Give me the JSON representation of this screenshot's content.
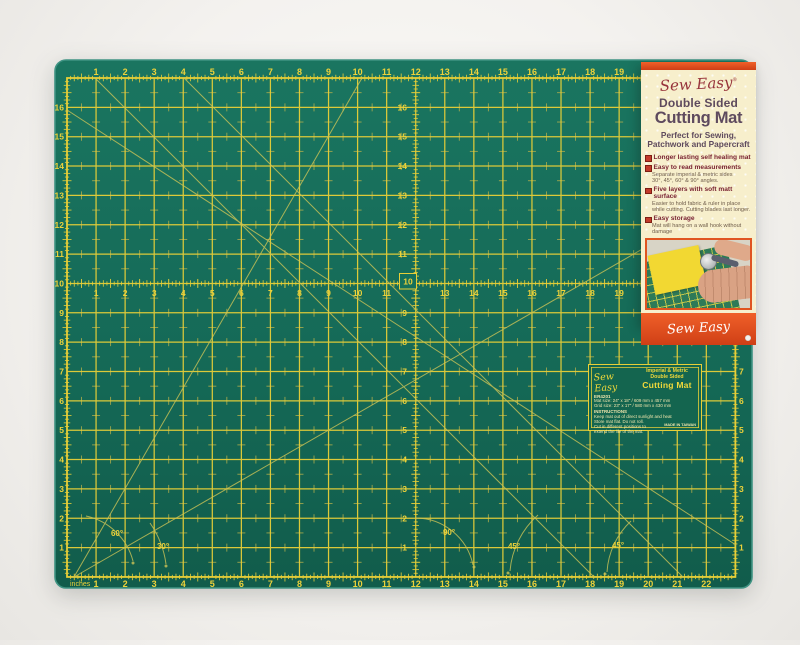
{
  "colors": {
    "background": "#f4f2ef",
    "mat_green": "#156a57",
    "mat_green_dark": "#115c4b",
    "mat_edge": "#3f9383",
    "grid_yellow": "#e7cf38",
    "grid_faint": "#b5b04c",
    "number_yellow": "#edd23a",
    "diagonal_yellow": "#cdc456",
    "label_cream": "#f7efcc",
    "label_orange": "#e3501e",
    "brand_red": "#97333b",
    "title_plum": "#5e4a5e",
    "bullet_red": "#c23b2a",
    "mat_label_text": "#f2e7ad"
  },
  "mat": {
    "unit_label": "inches",
    "rulers": {
      "top": [
        "1",
        "2",
        "3",
        "4",
        "5",
        "6",
        "7",
        "8",
        "9",
        "10",
        "11",
        "12",
        "13",
        "14",
        "15",
        "16",
        "17",
        "18",
        "19"
      ],
      "bottom": [
        "1",
        "2",
        "3",
        "4",
        "5",
        "6",
        "7",
        "8",
        "9",
        "10",
        "11",
        "12",
        "13",
        "14",
        "15",
        "16",
        "17",
        "18",
        "19",
        "20",
        "21",
        "22"
      ],
      "left": [
        "16",
        "15",
        "14",
        "13",
        "12",
        "11",
        "10",
        "9",
        "8",
        "7",
        "6",
        "5",
        "4",
        "3",
        "2",
        "1"
      ],
      "right": [
        "8",
        "7",
        "6",
        "5",
        "4",
        "3",
        "2",
        "1"
      ],
      "mid_horizontal": [
        "1",
        "2",
        "3",
        "4",
        "5",
        "6",
        "7",
        "8",
        "9",
        "10",
        "11",
        "13",
        "14",
        "15",
        "16",
        "17",
        "18",
        "19"
      ],
      "mid_vertical": [
        "16",
        "15",
        "14",
        "13",
        "12",
        "11",
        "9",
        "8",
        "7",
        "6",
        "5",
        "4",
        "3",
        "2",
        "1"
      ]
    },
    "center_marker": "10",
    "angle_labels": [
      {
        "text": "60°",
        "x": 117,
        "y": 536
      },
      {
        "text": "30°",
        "x": 163,
        "y": 549
      },
      {
        "text": "90°",
        "x": 449,
        "y": 535
      },
      {
        "text": "45°",
        "x": 514,
        "y": 549
      },
      {
        "text": "45°",
        "x": 618,
        "y": 548
      }
    ],
    "label": {
      "brand": "Sew Easy",
      "heading1": "Imperial & Metric",
      "heading2": "Double Sided",
      "heading3": "Cutting Mat",
      "code": "ER4201",
      "mat_size": "Mat size: 24\" x 18\" / 609 mm x 457 mm",
      "grid_size": "Grid size: 23\" x 17\" / 580 mm x 430 mm",
      "instructions_title": "INSTRUCTIONS",
      "instructions": [
        "Keep mat out of direct sunlight and heat",
        "Store mat flat. Do not roll.",
        "Cut in different positions to",
        "extend the life of the mat."
      ],
      "made_in": "MADE IN TAIWAN"
    }
  },
  "packaging": {
    "brand": "Sew Easy",
    "reg_mark": "®",
    "title1": "Double Sided",
    "title2": "Cutting Mat",
    "subtitle_line1": "Perfect for Sewing,",
    "subtitle_line2": "Patchwork and Papercraft",
    "features": [
      {
        "title": "Longer lasting self healing mat",
        "details": []
      },
      {
        "title": "Easy to read measurements",
        "details": [
          "Separate imperial & metric sides",
          "30°, 45°, 60° & 90° angles."
        ]
      },
      {
        "title": "Five layers with soft matt surface",
        "details": [
          "Easier to hold fabric & ruler in place",
          "while cutting. Cutting blades last longer."
        ]
      },
      {
        "title": "Easy storage",
        "details": [
          "Mat will hang on a wall hook without damage"
        ]
      }
    ],
    "footer_brand": "Sew Easy"
  }
}
